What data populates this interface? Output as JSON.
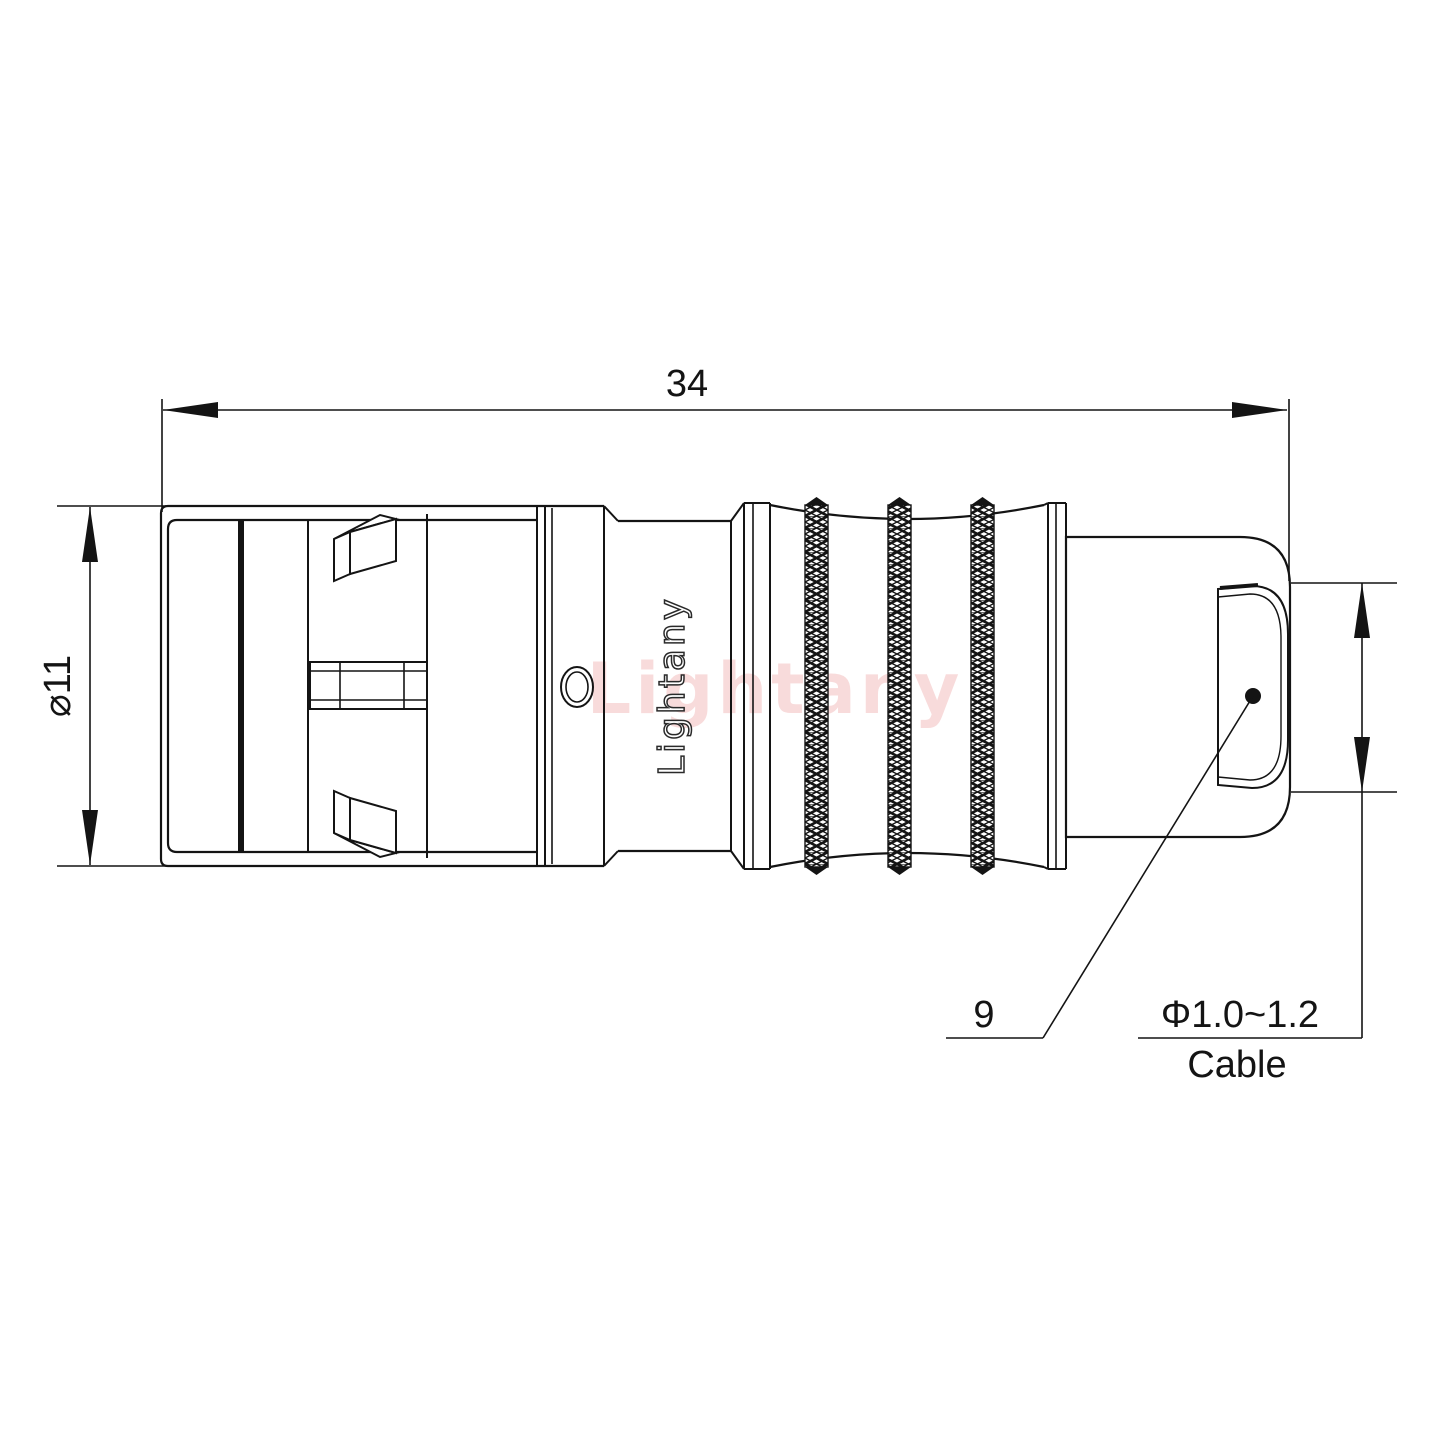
{
  "colors": {
    "background": "#ffffff",
    "line": "#141414",
    "watermark_pink": "#f3bfbf"
  },
  "dimensions": {
    "overall_length": "34",
    "outer_diameter": "⌀11",
    "boot_ref": "9",
    "cable_diameter": "Φ1.0~1.2",
    "cable_label": "Cable"
  },
  "branding": {
    "body_logo": "Lightany",
    "watermark": "Lightany"
  }
}
